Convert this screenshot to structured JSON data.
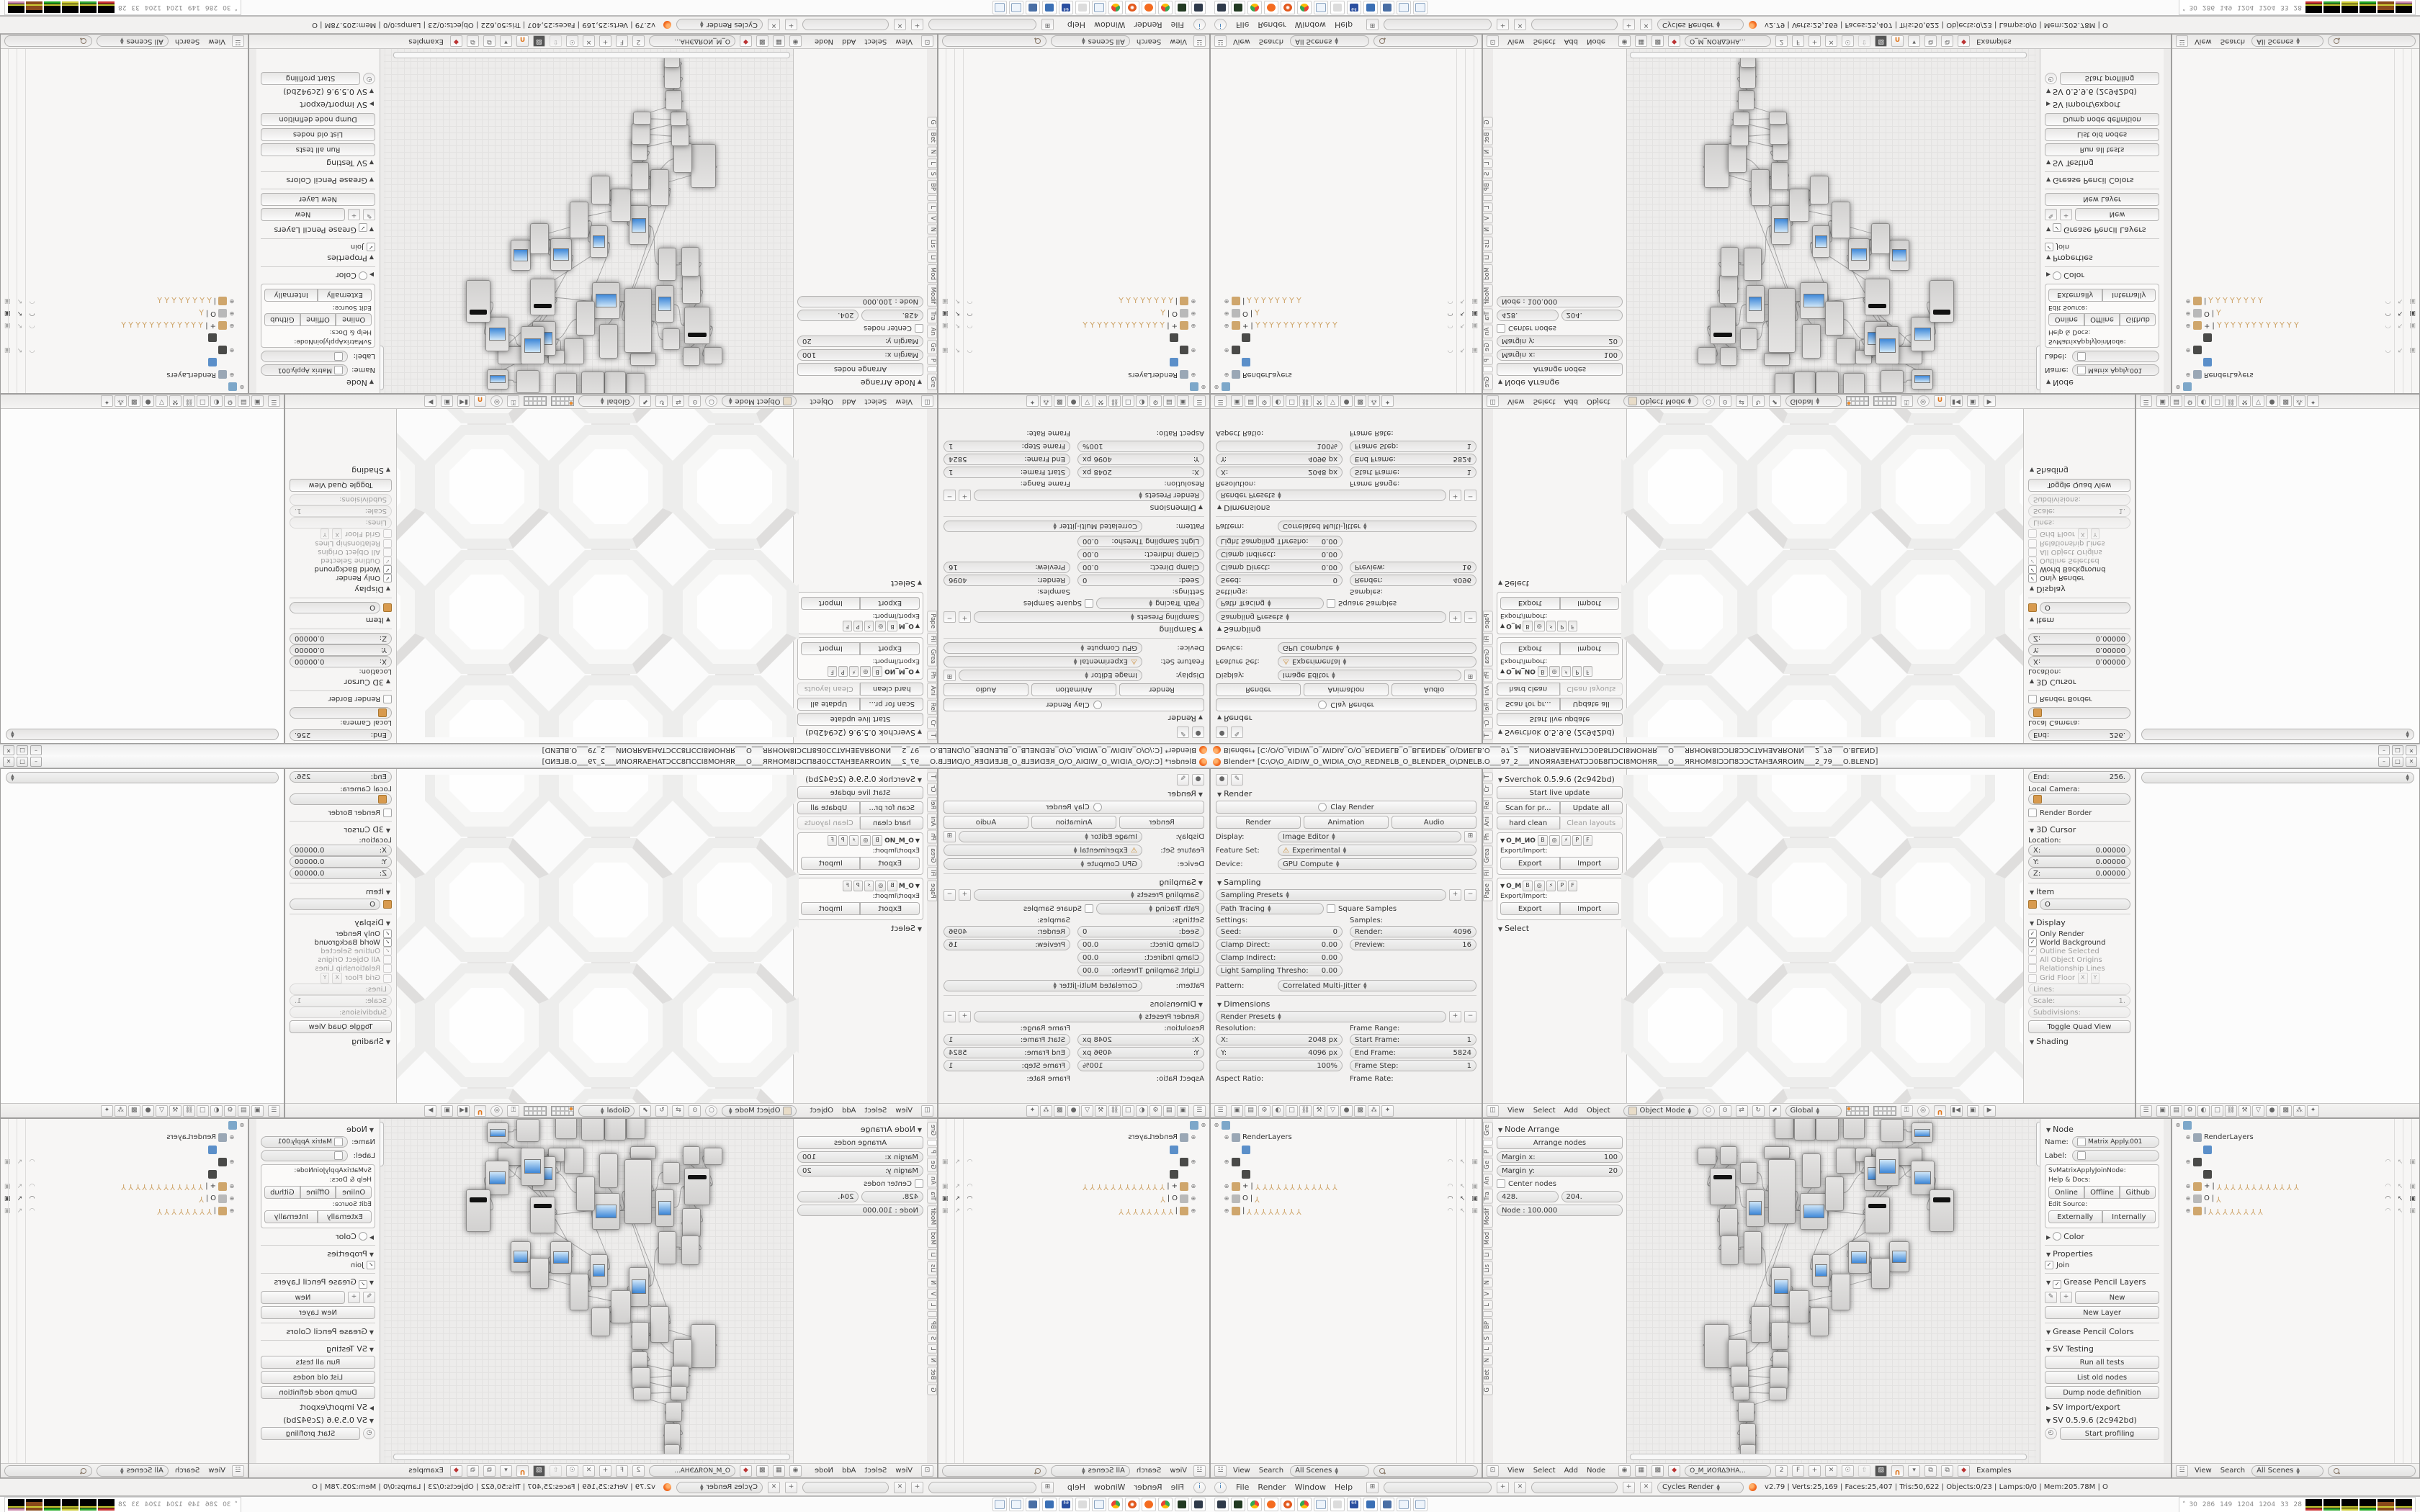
{
  "window": {
    "title": "Blender* [C:\\O\\O_AIDIW_O_WIDIA_O\\O_REDNELB_O_BLENDER_O\\DNELB.O___97_2___ИNOЯЯAƎEHATƆƆ0Б8ПƆCI8MOHЯR___O___ЯRHOM8IƆƆП8ƆƆCTAHƎAЯROИN___2_79___O.BLEND]",
    "buttons": {
      "minimize": "–",
      "maximize": "□",
      "close": "✕"
    }
  },
  "infobar": {
    "menus": [
      "File",
      "Render",
      "Window",
      "Help"
    ],
    "engine": "Cycles Render",
    "stats": "v2.79 | Verts:25,169 | Faces:25,407 | Tris:50,622 | Objects:0/23 | Lamps:0/0 | Mem:205.78M | O"
  },
  "taskbar": {
    "icons": [
      "system-monitor",
      "console-app",
      "chrome",
      "blender",
      "spiral-app",
      "chrome-2",
      "notepad",
      "volume",
      "floppy-64",
      "image-viewer",
      "calculator",
      "notepad-2",
      "notepad-3"
    ],
    "monitor": {
      "chevron": "˄",
      "values": [
        "30",
        "286",
        "149",
        "1204",
        "1204",
        "33",
        "28"
      ],
      "graphs": 6
    }
  },
  "props_render": {
    "render_panel": "Render",
    "clay": "Clay Render",
    "render_btn": "Render",
    "animation_btn": "Animation",
    "audio_btn": "Audio",
    "display_label": "Display:",
    "display_value": "Image Editor",
    "feature_label": "Feature Set:",
    "feature_value": "Experimental",
    "device_label": "Device:",
    "device_value": "GPU Compute",
    "sampling_panel": "Sampling",
    "sampling_presets": "Sampling Presets",
    "integrator": "Path Tracing",
    "square_samples": "Square Samples",
    "settings_label": "Settings:",
    "samples_label": "Samples:",
    "seed_label": "Seed:",
    "seed": "0",
    "clamp_direct_label": "Clamp Direct:",
    "clamp_direct": "0.00",
    "clamp_indirect_label": "Clamp Indirect:",
    "clamp_indirect": "0.00",
    "light_thresh_label": "Light Sampling Thresho:",
    "light_thresh": "0.00",
    "render_samples_label": "Render:",
    "render_samples": "4096",
    "preview_samples_label": "Preview:",
    "preview_samples": "16",
    "pattern_label": "Pattern:",
    "pattern": "Correlated Multi-Jitter",
    "dimensions_panel": "Dimensions",
    "render_presets": "Render Presets",
    "resolution_label": "Resolution:",
    "res_x_label": "X:",
    "res_x": "2048 px",
    "res_y_label": "Y:",
    "res_y": "4096 px",
    "res_pct": "100%",
    "frame_range_label": "Frame Range:",
    "start_frame_label": "Start Frame:",
    "start_frame": "1",
    "end_frame_label": "End Frame:",
    "end_frame": "5824",
    "frame_step_label": "Frame Step:",
    "frame_step": "1",
    "aspect_label": "Aspect Ratio:",
    "framerate_label": "Frame Rate:"
  },
  "view3d": {
    "tool_tabs": [
      "T",
      "Cr",
      "Rel",
      "Ani",
      "Ph",
      "Grea",
      "Fil",
      "Pape"
    ],
    "sverchok": {
      "panel": "Sverchok 0.5.9.6 (2c942bd)",
      "start_live": "Start live update",
      "scan": "Scan for pr...",
      "update_all": "Update all",
      "hard_clean": "hard clean",
      "clean_layouts": "Clean layouts",
      "export_import": "Export/Import:",
      "export": "Export",
      "import": "Import",
      "trees": [
        {
          "name": "O_I",
          "flags": [
            "B",
            "P",
            "F"
          ]
        },
        {
          "name": "O_M",
          "flags": [
            "B",
            "P",
            "F"
          ]
        }
      ],
      "select_panel": "Select"
    },
    "npanel": {
      "end_label": "End:",
      "end": "256.",
      "local_camera": "Local Camera:",
      "render_border": "Render Border",
      "cursor_panel": "3D Cursor",
      "location_label": "Location:",
      "x_label": "X:",
      "x": "0.00000",
      "y_label": "Y:",
      "y": "0.00000",
      "z_label": "Z:",
      "z": "0.00000",
      "item_panel": "Item",
      "item_name": "O",
      "display_panel": "Display",
      "only_render": "Only Render",
      "world_background": "World Background",
      "outline_selected": "Outline Selected",
      "all_origins": "All Object Origins",
      "relationship_lines": "Relationship Lines",
      "grid_floor": "Grid Floor",
      "gx": "X",
      "gy": "Y",
      "lines_label": "Lines:",
      "scale_label": "Scale:",
      "scale": "1.",
      "subdiv_label": "Subdivisions:",
      "quad_view": "Toggle Quad View",
      "shading_panel": "Shading"
    },
    "header": {
      "menus": [
        "View",
        "Select",
        "Add",
        "Object"
      ],
      "mode": "Object Mode",
      "orientation": "Global"
    }
  },
  "props_empty": {
    "note": ""
  },
  "outliner": {
    "header": {
      "view": "View",
      "search": "Search",
      "scenes": "All Scenes"
    },
    "rows": [
      {
        "indent": 0,
        "exp": true,
        "icon": "scene",
        "label": "",
        "bones": 0,
        "right": ""
      },
      {
        "indent": 1,
        "exp": true,
        "icon": "renderlayer",
        "label": "RenderLayers",
        "bones": 0,
        "right": ""
      },
      {
        "indent": 2,
        "exp": false,
        "icon": "world",
        "label": "",
        "bones": 0,
        "right": ""
      },
      {
        "indent": 1,
        "exp": true,
        "icon": "groupdark",
        "label": "",
        "bones": 0,
        "right": "dim"
      },
      {
        "indent": 2,
        "exp": false,
        "icon": "groupdark",
        "label": "",
        "bones": 0,
        "right": ""
      },
      {
        "indent": 1,
        "exp": true,
        "icon": "armature",
        "label": "+",
        "bones": 12,
        "right": "dim"
      },
      {
        "indent": 1,
        "exp": true,
        "icon": "meshdata",
        "label": "O",
        "bones": 1,
        "right": "active"
      },
      {
        "indent": 1,
        "exp": true,
        "icon": "armature",
        "label": "",
        "bones": 8,
        "right": "dim"
      }
    ]
  },
  "node_editor": {
    "tool_tabs": [
      "Gre",
      "",
      "P",
      "Ge",
      "An",
      "Tra",
      "Modif",
      "Mod",
      "Li",
      "Lis",
      "N",
      "V",
      "L",
      "",
      "BP",
      "S",
      "L",
      "N",
      "Bet",
      "G"
    ],
    "active_tab_index": 1,
    "arrange": {
      "panel": "Node Arrange",
      "arrange_btn": "Arrange nodes",
      "margin_x_label": "Margin x:",
      "margin_x": "100",
      "margin_y_label": "Margin y:",
      "margin_y": "20",
      "center_nodes": "Center nodes",
      "val1": "428.",
      "val2": "204.",
      "node_scale": "Node : 100.000"
    },
    "npanel": {
      "node_panel": "Node",
      "name_label": "Name:",
      "name": "Matrix Apply.001",
      "label_label": "Label:",
      "idname": "SvMatrixApplyJoinNode:",
      "help": "Help & Docs:",
      "online": "Online",
      "offline": "Offline",
      "github": "Github",
      "edit_source": "Edit Source:",
      "externally": "Externally",
      "internally": "Internally",
      "color_panel": "Color",
      "properties_panel": "Properties",
      "join": "Join",
      "gp_layers_panel": "Grease Pencil Layers",
      "new": "New",
      "new_layer": "New Layer",
      "gp_colors_panel": "Grease Pencil Colors",
      "sv_testing_panel": "SV Testing",
      "run_tests": "Run all tests",
      "list_old": "List old nodes",
      "dump_def": "Dump node definition",
      "sv_ie_panel": "SV import/export",
      "sv_ver_panel": "SV 0.5.9.6 (2c942bd)",
      "profiling": "Start profiling"
    },
    "header": {
      "menus": [
        "View",
        "Select",
        "Add",
        "Node"
      ],
      "tree_name": "O_M_ИOЯΔЭHA...",
      "users": "2",
      "fake": "F",
      "examples": "Examples"
    },
    "graph": {
      "nodes": [
        [
          205,
          -6,
          25,
          32,
          0
        ],
        [
          232,
          -8,
          28,
          36,
          0
        ],
        [
          262,
          -10,
          30,
          38,
          0
        ],
        [
          300,
          -8,
          28,
          34,
          0
        ],
        [
          98,
          40,
          24,
          22,
          0
        ],
        [
          129,
          38,
          22,
          24,
          0
        ],
        [
          115,
          68,
          34,
          50,
          2
        ],
        [
          157,
          60,
          22,
          28,
          0
        ],
        [
          190,
          38,
          34,
          16,
          0
        ],
        [
          196,
          56,
          36,
          88,
          0
        ],
        [
          165,
          98,
          24,
          50,
          1
        ],
        [
          243,
          48,
          24,
          46,
          0
        ],
        [
          240,
          103,
          37,
          49,
          1
        ],
        [
          275,
          80,
          24,
          46,
          0
        ],
        [
          290,
          40,
          26,
          34,
          0
        ],
        [
          317,
          40,
          21,
          18,
          0
        ],
        [
          329,
          52,
          31,
          46,
          1
        ],
        [
          374,
          40,
          34,
          23,
          0
        ],
        [
          330,
          108,
          33,
          49,
          2
        ],
        [
          128,
          124,
          24,
          38,
          0
        ],
        [
          130,
          162,
          23,
          39,
          0
        ],
        [
          162,
          156,
          23,
          44,
          0
        ],
        [
          200,
          206,
          26,
          53,
          1
        ],
        [
          257,
          188,
          23,
          43,
          1
        ],
        [
          307,
          170,
          28,
          43,
          1
        ],
        [
          364,
          170,
          26,
          41,
          1
        ],
        [
          339,
          193,
          24,
          41,
          0
        ],
        [
          284,
          215,
          24,
          49,
          0
        ],
        [
          225,
          238,
          26,
          44,
          0
        ],
        [
          254,
          262,
          24,
          38,
          0
        ],
        [
          172,
          260,
          24,
          49,
          0
        ],
        [
          107,
          285,
          33,
          59,
          0
        ],
        [
          140,
          306,
          24,
          39,
          0
        ],
        [
          200,
          282,
          22,
          37,
          0
        ],
        [
          202,
          323,
          21,
          26,
          0
        ],
        [
          144,
          343,
          23,
          28,
          0
        ],
        [
          198,
          345,
          24,
          28,
          0
        ],
        [
          147,
          371,
          21,
          18,
          0
        ],
        [
          197,
          373,
          23,
          16,
          0
        ],
        [
          154,
          393,
          21,
          26,
          0
        ],
        [
          156,
          423,
          21,
          31,
          0
        ],
        [
          157,
          452,
          20,
          14,
          0
        ],
        [
          345,
          40,
          31,
          51,
          1
        ],
        [
          394,
          58,
          31,
          46,
          1
        ],
        [
          420,
          98,
          32,
          57,
          2
        ],
        [
          352,
          0,
          30,
          30,
          0
        ],
        [
          395,
          5,
          28,
          26,
          1
        ]
      ],
      "links": [
        [
          4,
          6
        ],
        [
          5,
          6
        ],
        [
          6,
          10
        ],
        [
          7,
          9
        ],
        [
          8,
          9
        ],
        [
          9,
          12
        ],
        [
          10,
          12
        ],
        [
          11,
          12
        ],
        [
          12,
          18
        ],
        [
          13,
          16
        ],
        [
          14,
          16
        ],
        [
          15,
          16
        ],
        [
          16,
          18
        ],
        [
          17,
          18
        ],
        [
          9,
          22
        ],
        [
          19,
          20
        ],
        [
          20,
          21
        ],
        [
          21,
          22
        ],
        [
          22,
          28
        ],
        [
          23,
          27
        ],
        [
          24,
          26
        ],
        [
          25,
          26
        ],
        [
          26,
          27
        ],
        [
          27,
          28
        ],
        [
          28,
          29
        ],
        [
          29,
          30
        ],
        [
          30,
          31
        ],
        [
          31,
          32
        ],
        [
          32,
          33
        ],
        [
          33,
          34
        ],
        [
          34,
          35
        ],
        [
          35,
          36
        ],
        [
          36,
          37
        ],
        [
          37,
          38
        ],
        [
          38,
          39
        ],
        [
          39,
          40
        ],
        [
          40,
          41
        ],
        [
          42,
          43
        ],
        [
          43,
          44
        ],
        [
          45,
          46
        ],
        [
          46,
          42
        ],
        [
          18,
          23
        ],
        [
          12,
          23
        ],
        [
          16,
          24
        ],
        [
          6,
          19
        ],
        [
          9,
          30
        ],
        [
          22,
          30
        ],
        [
          28,
          33
        ]
      ]
    }
  },
  "honeycomb": {
    "pitch": 173,
    "columns": [
      -83,
      89,
      261,
      433,
      605
    ],
    "rows": [
      0,
      174,
      348,
      522
    ],
    "skip": [
      [
        0,
        0
      ],
      [
        4,
        0
      ],
      [
        0,
        3
      ],
      [
        4,
        3
      ]
    ]
  }
}
